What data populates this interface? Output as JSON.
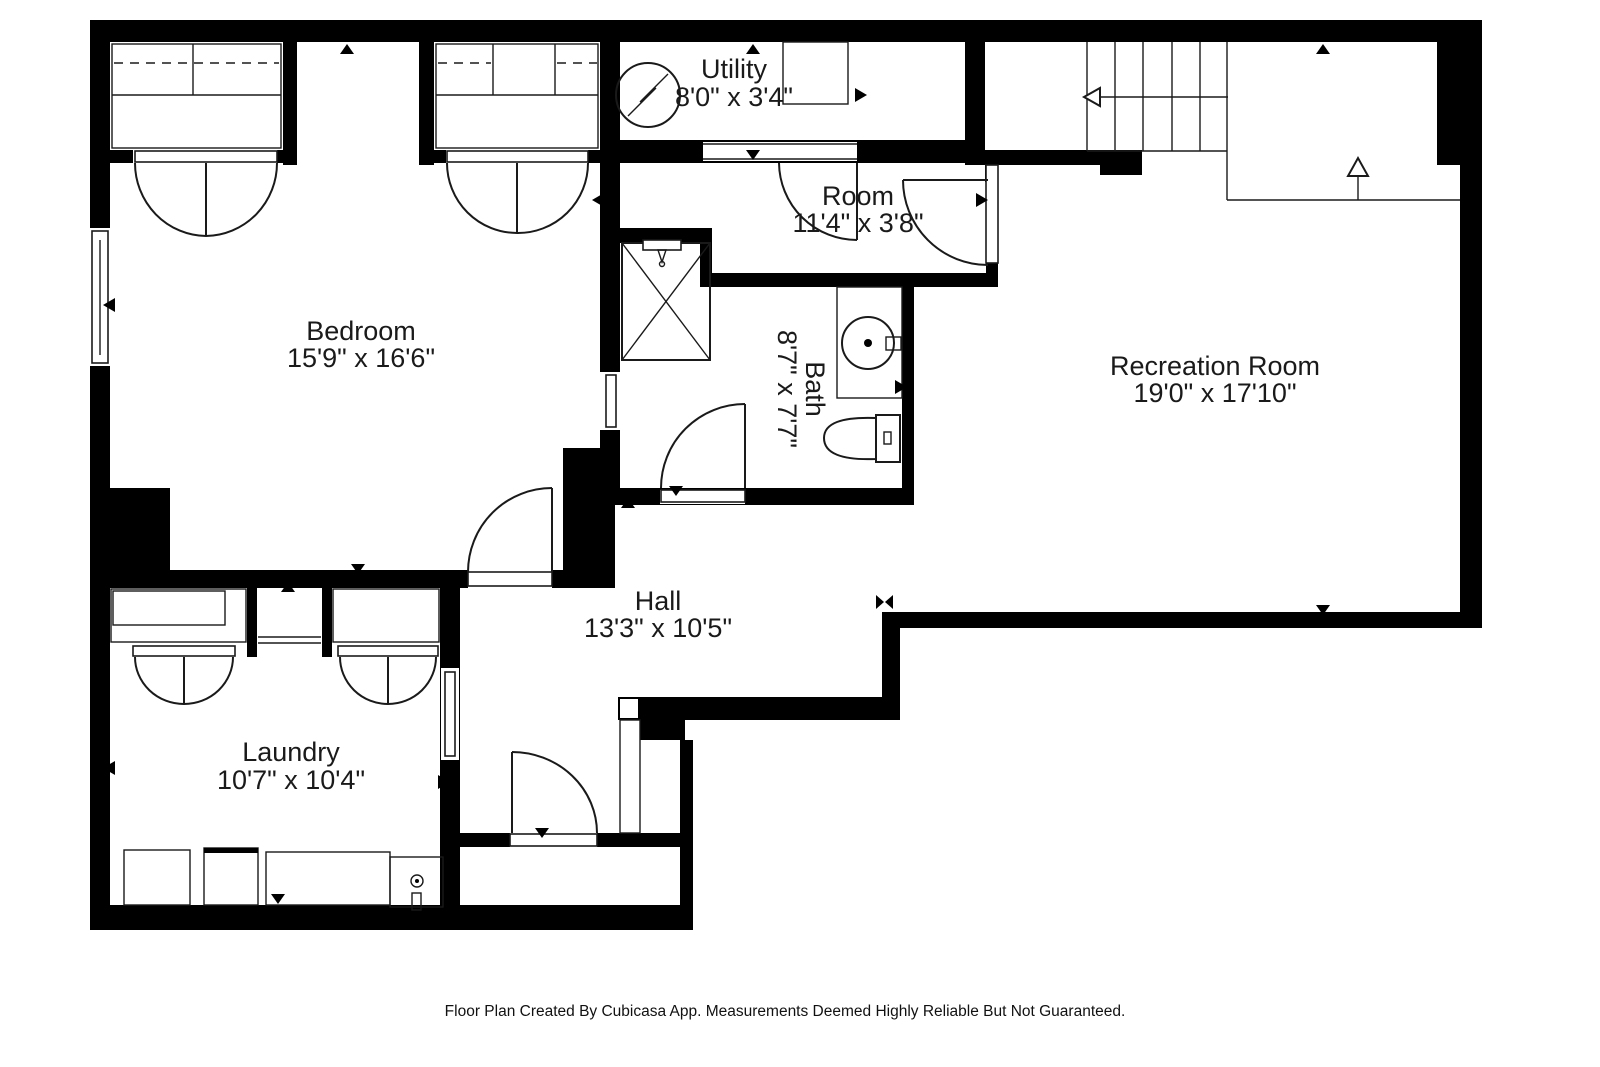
{
  "title": "Basement floor plan",
  "rooms": {
    "utility": {
      "name": "Utility",
      "dims": "8'0\" x 3'4\""
    },
    "room": {
      "name": "Room",
      "dims": "11'4\" x 3'8\""
    },
    "bedroom": {
      "name": "Bedroom",
      "dims": "15'9\" x 16'6\""
    },
    "bath": {
      "name": "Bath",
      "dims": "8'7\" x 7'7\""
    },
    "recreation": {
      "name": "Recreation Room",
      "dims": "19'0\" x 17'10\""
    },
    "hall": {
      "name": "Hall",
      "dims": "13'3\" x 10'5\""
    },
    "laundry": {
      "name": "Laundry",
      "dims": "10'7\" x 10'4\""
    }
  },
  "footer": {
    "text": "Floor Plan Created By Cubicasa App. Measurements Deemed Highly Reliable But Not Guaranteed."
  },
  "colors": {
    "wall": "#000000",
    "background": "#ffffff",
    "line": "#1a1a1a"
  },
  "icons": [
    "electrical-panel-icon",
    "shower-icon",
    "sink-icon",
    "toilet-icon",
    "washer-icon",
    "dryer-icon",
    "laundry-sink-icon",
    "stairs-up-arrow-icon",
    "stairs-direction-arrow-icon",
    "wall-marker-triangles",
    "window-symbols",
    "door-swing-arcs"
  ]
}
